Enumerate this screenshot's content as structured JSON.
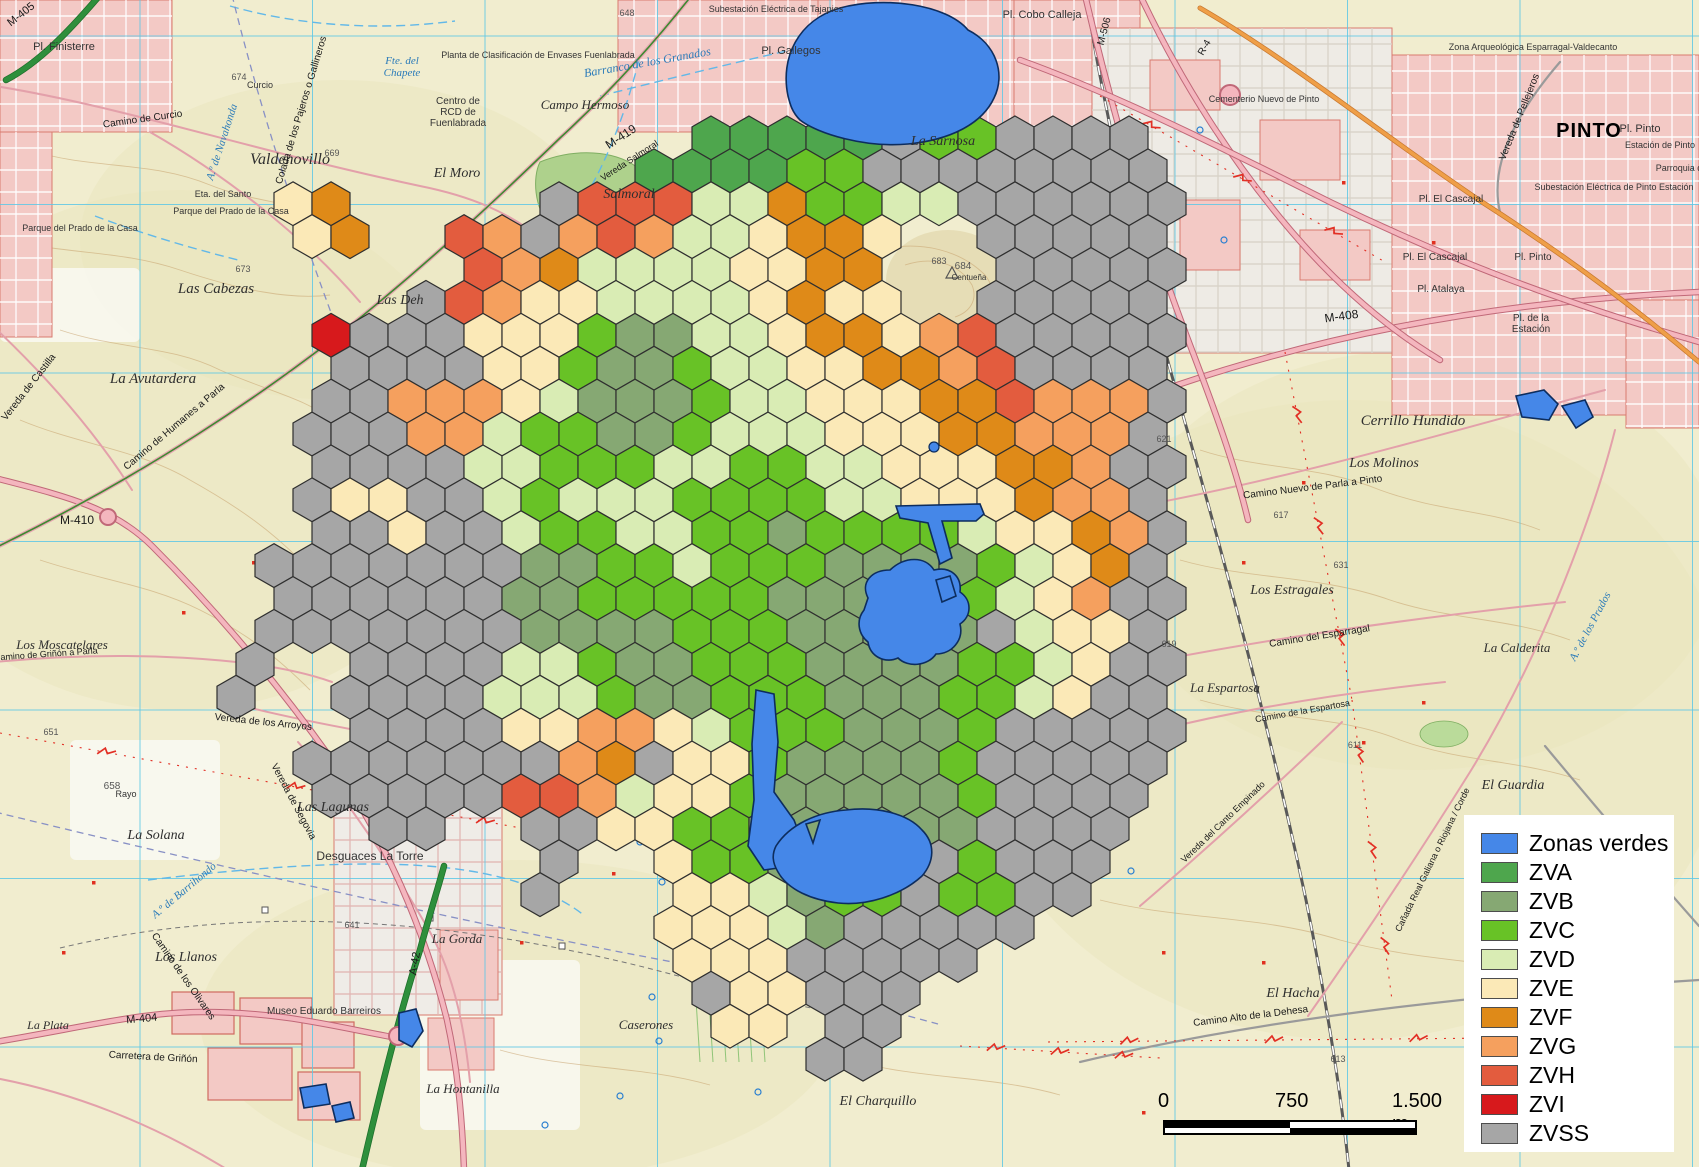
{
  "legend": {
    "items": [
      {
        "key": "V",
        "label": "Zonas verdes",
        "color": "#4587e8"
      },
      {
        "key": "A",
        "label": "ZVA",
        "color": "#4ea64d"
      },
      {
        "key": "B",
        "label": "ZVB",
        "color": "#86a873"
      },
      {
        "key": "C",
        "label": "ZVC",
        "color": "#68c226"
      },
      {
        "key": "D",
        "label": "ZVD",
        "color": "#d9ecb4"
      },
      {
        "key": "E",
        "label": "ZVE",
        "color": "#fbe9b7"
      },
      {
        "key": "F",
        "label": "ZVF",
        "color": "#df8a18"
      },
      {
        "key": "G",
        "label": "ZVG",
        "color": "#f5a05e"
      },
      {
        "key": "H",
        "label": "ZVH",
        "color": "#e35c3e"
      },
      {
        "key": "I",
        "label": "ZVI",
        "color": "#d7191c"
      },
      {
        "key": "S",
        "label": "ZVSS",
        "color": "#a6a6a6"
      }
    ]
  },
  "scalebar": {
    "labels": [
      "0",
      "750",
      "1.500 m"
    ]
  },
  "hex_grid": {
    "cols": 25,
    "rows": 30,
    "hex_width": 38,
    "origin_x": 236,
    "origin_y": 105,
    "row_step": 32.9,
    "classes": {
      "A": {
        "label": "ZVA",
        "color": "#4ea64d"
      },
      "B": {
        "label": "ZVB",
        "color": "#86a873"
      },
      "C": {
        "label": "ZVC",
        "color": "#68c226"
      },
      "D": {
        "label": "ZVD",
        "color": "#d9ecb4"
      },
      "E": {
        "label": "ZVE",
        "color": "#fbe9b7"
      },
      "F": {
        "label": "ZVF",
        "color": "#df8a18"
      },
      "G": {
        "label": "ZVG",
        "color": "#f5a05e"
      },
      "H": {
        "label": "ZVH",
        "color": "#e35c3e"
      },
      "I": {
        "label": "ZVI",
        "color": "#d7191c"
      },
      "S": {
        "label": "ZVSS",
        "color": "#a6a6a6"
      }
    },
    "rows_data": [
      ".........................",
      "............AAAAASCCSSSS.",
      "...........AAAACCSSSSSSSS",
      ".EF.....SHHHDDFCCDDSSSSSS",
      "..EF..HGSGHGDDEFFE..SSSSS",
      "......HGFDDDDEEFF...SSSSS",
      ".....SHGEEDDDDEFEE..SSSSS",
      "..ISSSEEECBBDDEFFEGHSSSSS",
      "...SSSSEECBBCDDEEFFGHSSSS",
      "..SSGGGEDBBBCDDEEEFFHGGGS",
      "..SSSGGDCCBBCDDDEEEFFGGGS",
      "..SSSSDDCCCDDCCDDEEEFFGSS",
      "..SEESSDCDDDCCCCDDEEEFGGS",
      "..SSESSDCCDDCCBCCCCDEEFGS",
      ".SSSSSSSBBCCDCCCBBBBCDEFS",
      ".SSSSSSBBCCCCCBBBBBCDEGSS",
      ".SSSSSSSBBBBCCCBBBBBSDEES",
      "S..SSSSDDCBBCCCBBBBCCDESS",
      "S..SSSSDDDCBBCCCBBBCCDESS",
      "...SSSSEEGGEDCCCBBBCSSSSS",
      "..SSSSSSSGFSEECBBBBCSSSSS",
      "..SSSSSHHGDEECBBBBBCSSSS.",
      "....SS..SSEECCBBBBBBSSSS.",
      "........S..ECCBBBSSCSSS..",
      "........S...EEDBCCSCCSS..",
      "...........EEEDBSSSSS....",
      "............EEESSSSS.....",
      "............SEESSS.......",
      ".............EE.SS.......",
      "...............SS........"
    ]
  },
  "zonas_verdes": {
    "color": "#4587e8",
    "outline": "#0d2d5e",
    "polygons": [
      "M788,96 C780,58 798,20 840,8 C884,-4 946,4 968,30 C996,44 1006,74 994,98 C982,124 950,140 908,144 C866,148 818,134 800,120 C792,112 790,104 788,96 Z",
      "M868,598 C860,582 872,570 890,570 C905,556 925,556 934,570 C950,566 962,576 960,592 C972,600 972,616 960,624 C964,640 952,654 936,654 C928,666 908,668 898,658 C884,664 870,656 868,642 C858,634 856,620 864,610 Z",
      "M896,506 L980,504 L984,514 L976,521 L942,521 L952,558 L940,564 L928,523 L900,518 Z",
      "M936,580 L950,576 L956,596 L942,602 Z",
      "M756,690 L774,694 L778,742 L774,792 L794,820 L804,846 L792,866 L764,870 L748,846 L754,800 L752,744 Z",
      "M776,846 C790,824 818,812 846,810 C878,806 908,814 922,830 C936,844 934,862 922,876 C900,896 866,906 838,903 C812,900 788,890 778,872 C772,862 772,854 776,846 Z M806,824 L820,820 L813,843 Z",
      "M1516,396 L1544,390 L1558,404 L1549,420 L1522,417 Z",
      "M1562,406 L1585,400 L1593,417 L1576,428 Z",
      "M399,1013 L416,1009 L423,1031 L412,1047 L399,1040 Z",
      "M300,1088 L326,1084 L330,1104 L304,1108 Z",
      "M332,1106 L350,1102 L354,1118 L336,1122 Z"
    ],
    "dots": [
      [
        934,
        447,
        5
      ]
    ]
  },
  "map_labels": [
    {
      "t": "Valdenovillo",
      "x": 290,
      "y": 164,
      "c": "place",
      "s": 16
    },
    {
      "t": "Las Cabezas",
      "x": 216,
      "y": 293,
      "c": "place",
      "s": 15
    },
    {
      "t": "La Avutardera",
      "x": 153,
      "y": 383,
      "c": "place",
      "s": 15
    },
    {
      "t": "Los Moscatelares",
      "x": 62,
      "y": 649,
      "c": "place",
      "s": 13
    },
    {
      "t": "Las Lagunas",
      "x": 333,
      "y": 811,
      "c": "place",
      "s": 14
    },
    {
      "t": "La Solana",
      "x": 156,
      "y": 839,
      "c": "place",
      "s": 14
    },
    {
      "t": "Los Llanos",
      "x": 186,
      "y": 961,
      "c": "place",
      "s": 14
    },
    {
      "t": "La Plata",
      "x": 48,
      "y": 1029,
      "c": "place",
      "s": 12
    },
    {
      "t": "El Moro",
      "x": 457,
      "y": 177,
      "c": "place",
      "s": 14
    },
    {
      "t": "Salmoral",
      "x": 629,
      "y": 198,
      "c": "place",
      "s": 14
    },
    {
      "t": "Campo Hermoso",
      "x": 585,
      "y": 109,
      "c": "place",
      "s": 13
    },
    {
      "t": "Las Deh",
      "x": 400,
      "y": 304,
      "c": "place",
      "s": 14
    },
    {
      "t": "El Charquillo",
      "x": 878,
      "y": 1105,
      "c": "place",
      "s": 14
    },
    {
      "t": "Caserones",
      "x": 646,
      "y": 1029,
      "c": "place",
      "s": 13
    },
    {
      "t": "La Hontanilla",
      "x": 463,
      "y": 1093,
      "c": "place",
      "s": 13
    },
    {
      "t": "La Gorda",
      "x": 457,
      "y": 943,
      "c": "place",
      "s": 13
    },
    {
      "t": "El Hacha",
      "x": 1293,
      "y": 997,
      "c": "place",
      "s": 14
    },
    {
      "t": "El Guardia",
      "x": 1513,
      "y": 789,
      "c": "place",
      "s": 14
    },
    {
      "t": "La Calderita",
      "x": 1517,
      "y": 652,
      "c": "place",
      "s": 13
    },
    {
      "t": "La Espartosa",
      "x": 1225,
      "y": 692,
      "c": "place",
      "s": 13
    },
    {
      "t": "Los Estragales",
      "x": 1292,
      "y": 594,
      "c": "place",
      "s": 14
    },
    {
      "t": "Los Molinos",
      "x": 1384,
      "y": 467,
      "c": "place",
      "s": 14
    },
    {
      "t": "Cerrillo Hundido",
      "x": 1413,
      "y": 425,
      "c": "place",
      "s": 15
    },
    {
      "t": "La Sarnosa",
      "x": 943,
      "y": 145,
      "c": "place",
      "s": 14
    },
    {
      "t": "Desguaces La Torre",
      "x": 370,
      "y": 860,
      "c": "sans",
      "s": 12
    },
    {
      "t": "Pl. Finisterre",
      "x": 64,
      "y": 50,
      "c": "sans",
      "s": 11
    },
    {
      "t": "Pl. Gallegos",
      "x": 791,
      "y": 54,
      "c": "sans",
      "s": 11
    },
    {
      "t": "Pl. Cobo Calleja",
      "x": 1042,
      "y": 18,
      "c": "sans",
      "s": 11
    },
    {
      "t": "Centro de\nRCD de\nFuenlabrada",
      "x": 458,
      "y": 104,
      "c": "sans",
      "s": 10
    },
    {
      "t": "Planta de Clasificación de Envases Fuenlabrada",
      "x": 538,
      "y": 58,
      "c": "sans",
      "s": 9
    },
    {
      "t": "Subestación Eléctrica de Tajapies",
      "x": 776,
      "y": 12,
      "c": "sans",
      "s": 9
    },
    {
      "t": "Eta. del Santo",
      "x": 223,
      "y": 197,
      "c": "sans",
      "s": 9
    },
    {
      "t": "Parque del Prado de la Casa",
      "x": 231,
      "y": 214,
      "c": "sans",
      "s": 9
    },
    {
      "t": "Parque del Prado de la Casa",
      "x": 80,
      "y": 231,
      "c": "sans",
      "s": 9
    },
    {
      "t": "Curcio",
      "x": 260,
      "y": 88,
      "c": "sans",
      "s": 9
    },
    {
      "t": "Museo Eduardo Barreiros",
      "x": 324,
      "y": 1014,
      "c": "sans",
      "s": 10
    },
    {
      "t": "Rayo",
      "x": 126,
      "y": 797,
      "c": "sans",
      "s": 9
    },
    {
      "t": "Cementerio Nuevo de Pinto",
      "x": 1264,
      "y": 102,
      "c": "sans",
      "s": 9
    },
    {
      "t": "Zona Arqueológica Esparragal-Valdecanto",
      "x": 1533,
      "y": 50,
      "c": "sans",
      "s": 9
    },
    {
      "t": "PINTO",
      "x": 1589,
      "y": 137,
      "c": "city",
      "s": 20
    },
    {
      "t": "Pl. Pinto",
      "x": 1640,
      "y": 132,
      "c": "sans",
      "s": 11
    },
    {
      "t": "Estación de Pinto",
      "x": 1660,
      "y": 148,
      "c": "sans",
      "s": 9
    },
    {
      "t": "Parroquia d",
      "x": 1679,
      "y": 171,
      "c": "sans",
      "s": 9
    },
    {
      "t": "Subestación Eléctrica de Pinto Estación",
      "x": 1614,
      "y": 190,
      "c": "sans",
      "s": 9
    },
    {
      "t": "Pl. El Cascajal",
      "x": 1451,
      "y": 202,
      "c": "sans",
      "s": 10
    },
    {
      "t": "Pl. El Cascajal",
      "x": 1435,
      "y": 260,
      "c": "sans",
      "s": 10
    },
    {
      "t": "Pl. Pinto",
      "x": 1533,
      "y": 260,
      "c": "sans",
      "s": 10
    },
    {
      "t": "Pl. Atalaya",
      "x": 1441,
      "y": 292,
      "c": "sans",
      "s": 10
    },
    {
      "t": "Pl. de la\nEstación",
      "x": 1531,
      "y": 321,
      "c": "sans",
      "s": 10
    },
    {
      "t": "M-405",
      "x": 23,
      "y": 17,
      "c": "road",
      "s": 11,
      "r": -38
    },
    {
      "t": "M-410",
      "x": 77,
      "y": 524,
      "c": "road",
      "s": 12
    },
    {
      "t": "M-404",
      "x": 142,
      "y": 1022,
      "c": "road",
      "s": 11,
      "r": -5
    },
    {
      "t": "M-419",
      "x": 623,
      "y": 140,
      "c": "road",
      "s": 12,
      "r": -33
    },
    {
      "t": "Vereda Salmoral",
      "x": 631,
      "y": 163,
      "c": "road",
      "s": 9,
      "r": -33
    },
    {
      "t": "A-42",
      "x": 418,
      "y": 964,
      "c": "road",
      "s": 11,
      "r": -80
    },
    {
      "t": "R-4",
      "x": 1207,
      "y": 49,
      "c": "road",
      "s": 10,
      "r": -60
    },
    {
      "t": "M-506",
      "x": 1107,
      "y": 32,
      "c": "road",
      "s": 10,
      "r": -75
    },
    {
      "t": "M-408",
      "x": 1342,
      "y": 320,
      "c": "road",
      "s": 12,
      "r": -8
    },
    {
      "t": "Camino de Curcio",
      "x": 143,
      "y": 122,
      "c": "road",
      "s": 10,
      "r": -8
    },
    {
      "t": "Camino de Humanes a Parla",
      "x": 176,
      "y": 429,
      "c": "road",
      "s": 10,
      "r": -40
    },
    {
      "t": "Colada de los Pajeros o Gallineros",
      "x": 304,
      "y": 111,
      "c": "road",
      "s": 10,
      "r": -73
    },
    {
      "t": "Vereda de Castilla",
      "x": 31,
      "y": 389,
      "c": "road",
      "s": 10,
      "r": -52
    },
    {
      "t": "Vereda de los Arroyos",
      "x": 263,
      "y": 725,
      "c": "road",
      "s": 10,
      "r": 6
    },
    {
      "t": "Vereda de Segovia",
      "x": 291,
      "y": 803,
      "c": "road",
      "s": 10,
      "r": 62
    },
    {
      "t": "Camino de los Olivares",
      "x": 181,
      "y": 978,
      "c": "road",
      "s": 10,
      "r": 55
    },
    {
      "t": "Carretera de Griñón",
      "x": 153,
      "y": 1060,
      "c": "road",
      "s": 10,
      "r": 3
    },
    {
      "t": "Camino de Griñón a Parla",
      "x": 46,
      "y": 657,
      "c": "road",
      "s": 9,
      "r": -4
    },
    {
      "t": "Camino Nuevo de Parla a Pinto",
      "x": 1313,
      "y": 490,
      "c": "road",
      "s": 10,
      "r": -7
    },
    {
      "t": "Camino del Esparragal",
      "x": 1320,
      "y": 639,
      "c": "road",
      "s": 10,
      "r": -9
    },
    {
      "t": "Camino de la Espartosa",
      "x": 1303,
      "y": 714,
      "c": "road",
      "s": 9,
      "r": -10
    },
    {
      "t": "Cañada Real Galiana o Riojana / Corde",
      "x": 1435,
      "y": 861,
      "c": "road",
      "s": 9,
      "r": -64
    },
    {
      "t": "Vereda del Canto Empinado",
      "x": 1225,
      "y": 824,
      "c": "road",
      "s": 9,
      "r": -44
    },
    {
      "t": "Camino Alto de la Dehesa",
      "x": 1251,
      "y": 1019,
      "c": "road",
      "s": 10,
      "r": -7
    },
    {
      "t": "Vereda de Pellejeros",
      "x": 1522,
      "y": 118,
      "c": "road",
      "s": 10,
      "r": -68
    },
    {
      "t": "Barranco de los Granados",
      "x": 648,
      "y": 66,
      "c": "stream",
      "s": 12,
      "r": -10
    },
    {
      "t": "A.º de Navahonda",
      "x": 225,
      "y": 143,
      "c": "stream",
      "s": 11,
      "r": -72
    },
    {
      "t": "A.º de Barrihondo",
      "x": 186,
      "y": 893,
      "c": "stream",
      "s": 11,
      "r": -40
    },
    {
      "t": "A.º de los Prados",
      "x": 1593,
      "y": 628,
      "c": "stream",
      "s": 11,
      "r": -62
    },
    {
      "t": "Fte. del\nChapete",
      "x": 402,
      "y": 64,
      "c": "stream",
      "s": 11
    },
    {
      "t": "674",
      "x": 239,
      "y": 80,
      "c": "spot",
      "s": 9
    },
    {
      "t": "673",
      "x": 243,
      "y": 272,
      "c": "spot",
      "s": 9
    },
    {
      "t": "669",
      "x": 332,
      "y": 156,
      "c": "spot",
      "s": 9
    },
    {
      "t": "648",
      "x": 627,
      "y": 16,
      "c": "spot",
      "s": 9
    },
    {
      "t": "684",
      "x": 963,
      "y": 269,
      "c": "spot",
      "s": 10
    },
    {
      "t": "Centueña",
      "x": 969,
      "y": 280,
      "c": "sans",
      "s": 8
    },
    {
      "t": "683",
      "x": 939,
      "y": 264,
      "c": "spot",
      "s": 9
    },
    {
      "t": "651",
      "x": 51,
      "y": 735,
      "c": "spot",
      "s": 9
    },
    {
      "t": "658",
      "x": 112,
      "y": 789,
      "c": "spot",
      "s": 10
    },
    {
      "t": "613",
      "x": 1338,
      "y": 1062,
      "c": "spot",
      "s": 9
    },
    {
      "t": "611",
      "x": 1355,
      "y": 748,
      "c": "spot",
      "s": 9
    },
    {
      "t": "621",
      "x": 1164,
      "y": 442,
      "c": "spot",
      "s": 9
    },
    {
      "t": "631",
      "x": 1341,
      "y": 568,
      "c": "spot",
      "s": 9
    },
    {
      "t": "617",
      "x": 1281,
      "y": 518,
      "c": "spot",
      "s": 9
    },
    {
      "t": "619",
      "x": 1169,
      "y": 647,
      "c": "spot",
      "s": 9
    },
    {
      "t": "641",
      "x": 352,
      "y": 928,
      "c": "spot",
      "s": 9
    }
  ]
}
